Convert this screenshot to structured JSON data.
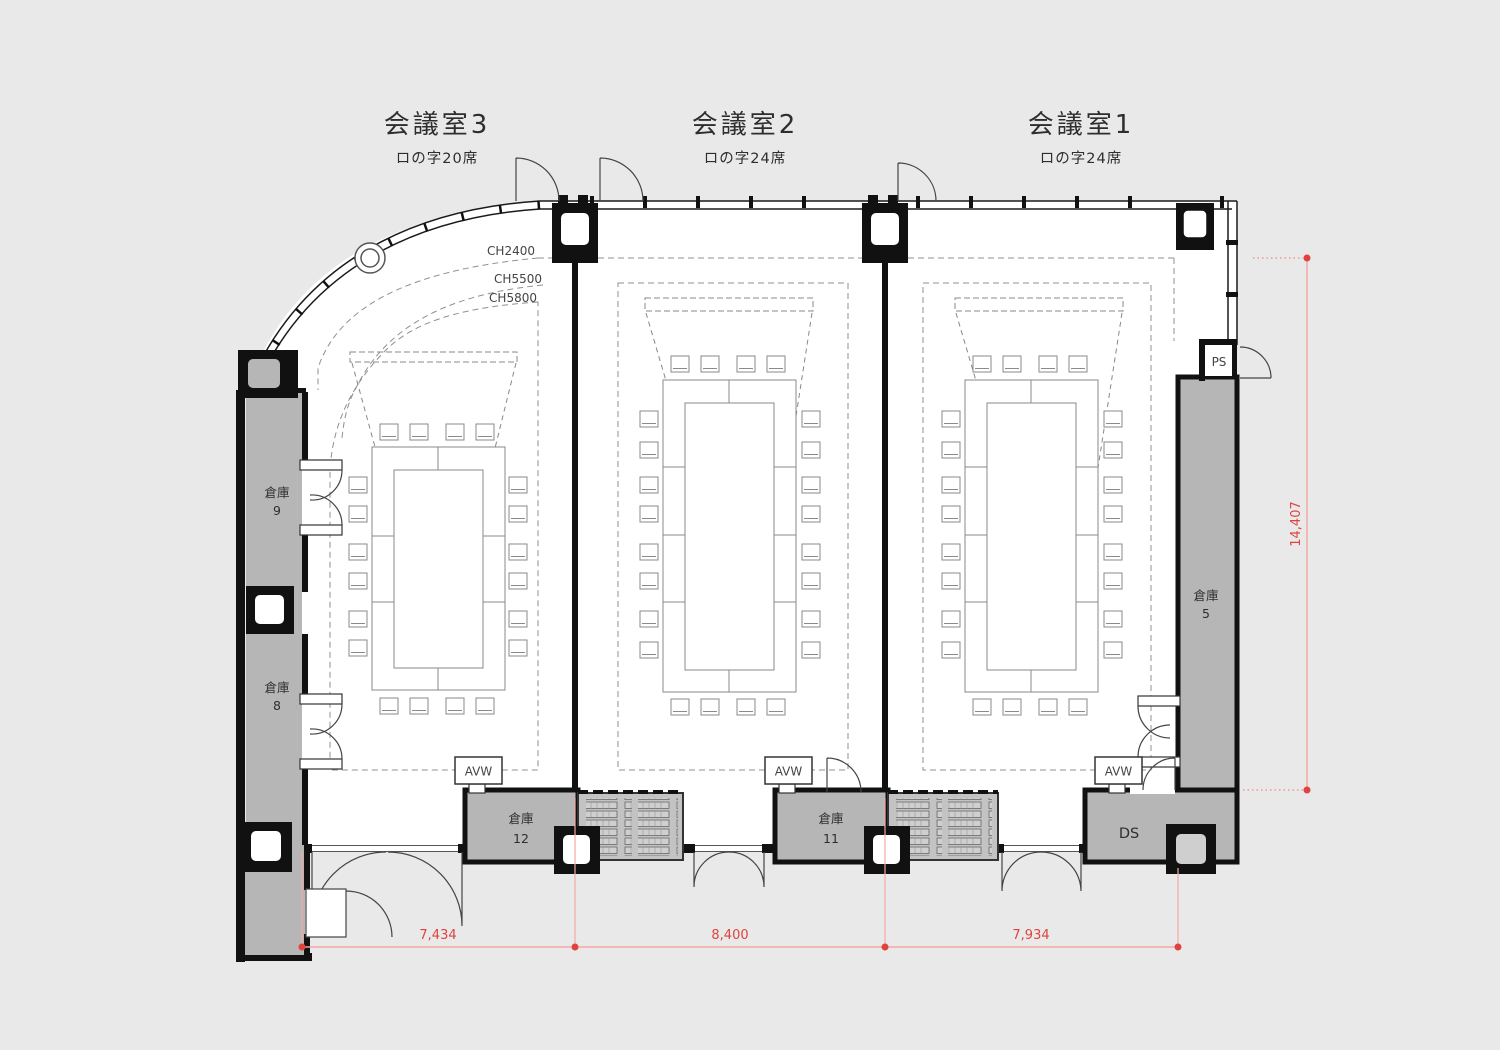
{
  "plan_title": "Conference room floor plan",
  "rooms": [
    {
      "title": "会議室3",
      "subtitle": "ロの字20席"
    },
    {
      "title": "会議室2",
      "subtitle": "ロの字24席"
    },
    {
      "title": "会議室1",
      "subtitle": "ロの字24席"
    }
  ],
  "ceiling_labels": {
    "ch2400": "CH2400",
    "ch5500": "CH5500",
    "ch5800": "CH5800"
  },
  "storages": {
    "s9": {
      "label": "倉庫",
      "num": "9"
    },
    "s8": {
      "label": "倉庫",
      "num": "8"
    },
    "s5": {
      "label": "倉庫",
      "num": "5"
    },
    "s12": {
      "label": "倉庫",
      "num": "12"
    },
    "s11": {
      "label": "倉庫",
      "num": "11"
    }
  },
  "utility": {
    "ps": "PS",
    "ds": "DS",
    "avw": "AVW"
  },
  "dimensions": {
    "bottom": [
      "7,434",
      "8,400",
      "7,934"
    ],
    "right": "14,407"
  },
  "colors": {
    "background": "#e9e9e9",
    "wall": "#141414",
    "storage_fill": "#b6b6b6",
    "dim_red": "#e0433d",
    "dim_line": "#f4a9a5",
    "line_gray": "#8a8a8a"
  }
}
